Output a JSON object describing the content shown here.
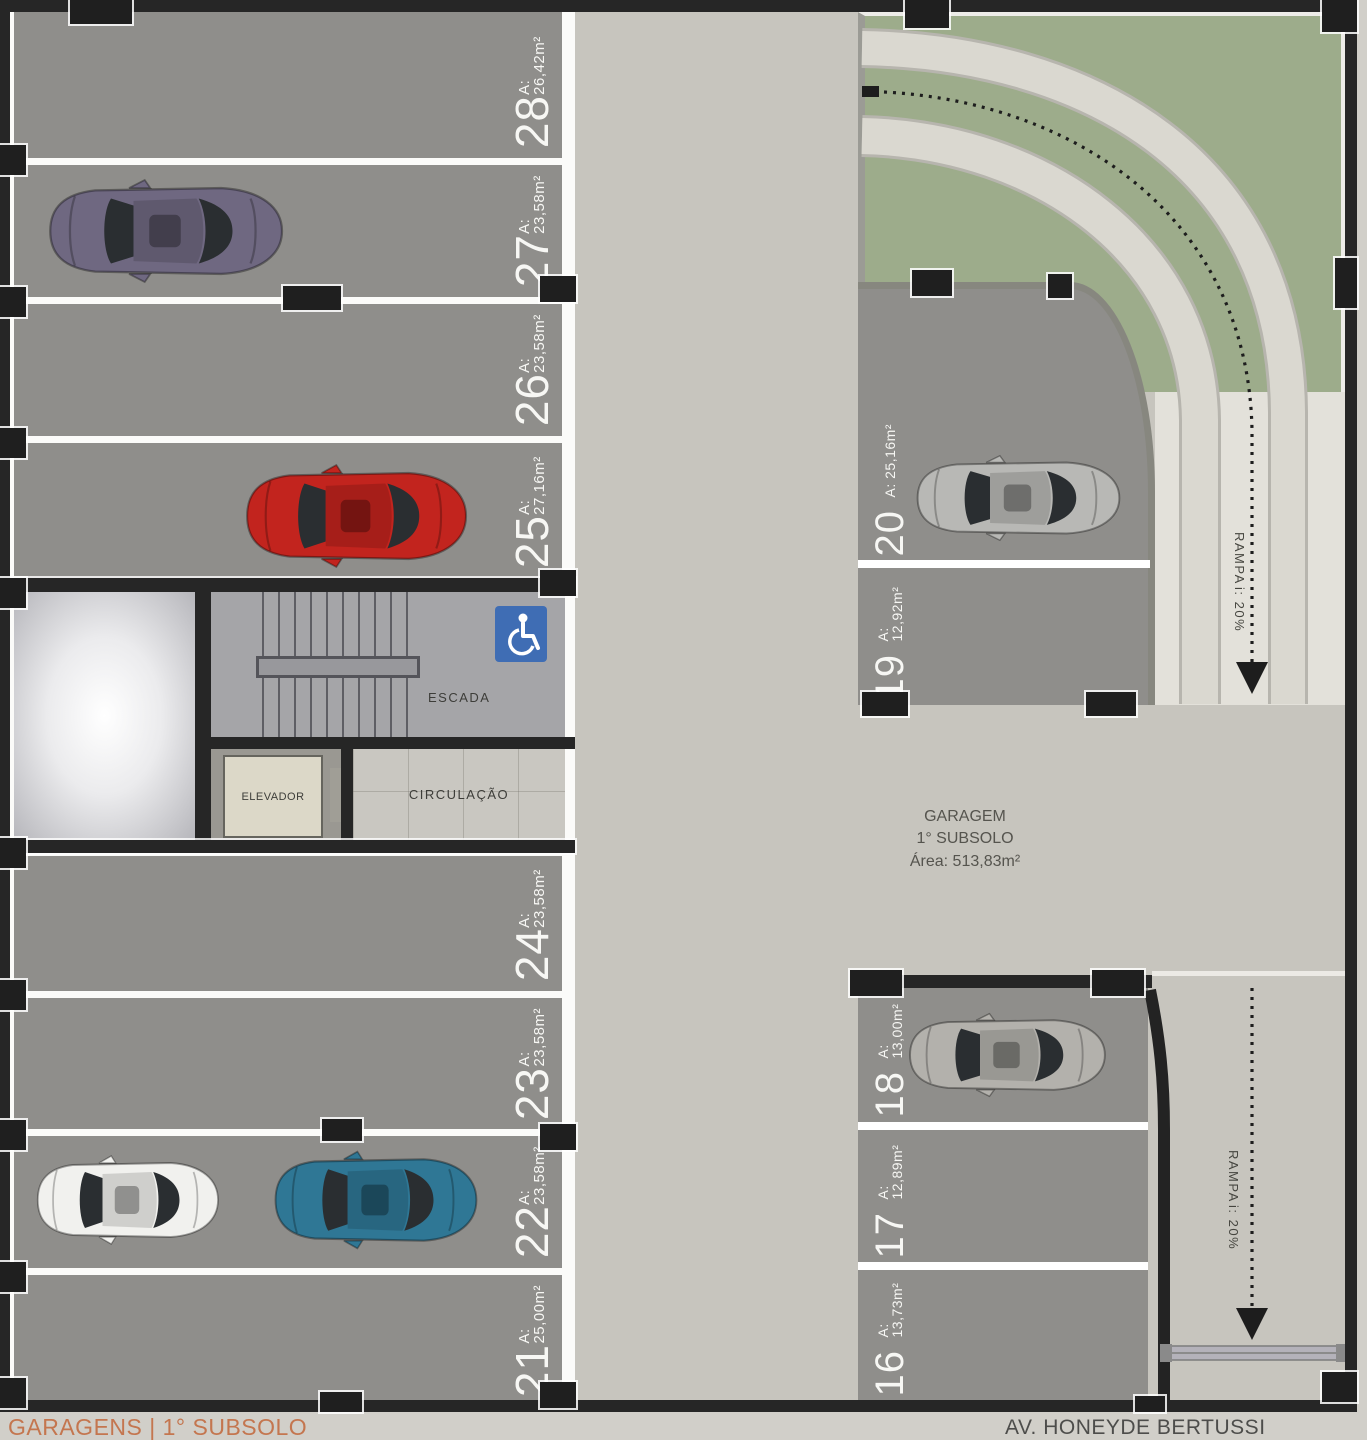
{
  "footer": {
    "left": "GARAGENS | 1° SUBSOLO",
    "right": "AV. HONEYDE BERTUSSI"
  },
  "garage_info": {
    "name": "GARAGEM",
    "level": "1° SUBSOLO",
    "area": "Área: 513,83m²"
  },
  "rooms": {
    "stairs": "ESCADA",
    "elevator": "ELEVADOR",
    "circulation": "CIRCULAÇÃO"
  },
  "ramp_top": {
    "name": "RAMPA",
    "slope": "i: 20%"
  },
  "ramp_bottom": {
    "name": "RAMPA",
    "slope": "i: 20%"
  },
  "spaces_left": [
    {
      "number": "28",
      "area": "A: 26,42m²"
    },
    {
      "number": "27",
      "area": "A: 23,58m²"
    },
    {
      "number": "26",
      "area": "A: 23,58m²"
    },
    {
      "number": "25",
      "area": "A: 27,16m²"
    },
    {
      "number": "24",
      "area": "A: 23,58m²"
    },
    {
      "number": "23",
      "area": "A: 23,58m²"
    },
    {
      "number": "22",
      "area": "A: 23,58m²"
    },
    {
      "number": "21",
      "area": "A: 25,00m²"
    }
  ],
  "spaces_right_top": [
    {
      "number": "20",
      "area": "A: 25,16m²"
    },
    {
      "number": "19",
      "area": "A: 12,92m²"
    }
  ],
  "spaces_right_bottom": [
    {
      "number": "18",
      "area": "A: 13,00m²"
    },
    {
      "number": "17",
      "area": "A: 12,89m²"
    },
    {
      "number": "16",
      "area": "A: 13,73m²"
    }
  ],
  "cars": [
    {
      "space": "27",
      "color": "#6f6881"
    },
    {
      "space": "25",
      "color": "#c2241e"
    },
    {
      "space": "22a",
      "color": "#f1f1ee"
    },
    {
      "space": "22b",
      "color": "#2f7795"
    },
    {
      "space": "20",
      "color": "#b8b8b5"
    },
    {
      "space": "18",
      "color": "#b3b1ac"
    }
  ],
  "icons": {
    "accessibility": "wheelchair"
  },
  "colors": {
    "wall": "#262626",
    "space_gray": "#8f8e8b",
    "aisle_concrete": "#c7c5be",
    "landscape_green": "#9dac8b",
    "ramp_band": "#dad8d0",
    "accessibility_blue": "#3f6db4",
    "accent_orange": "#c4764f",
    "separator_white": "#ffffff"
  }
}
